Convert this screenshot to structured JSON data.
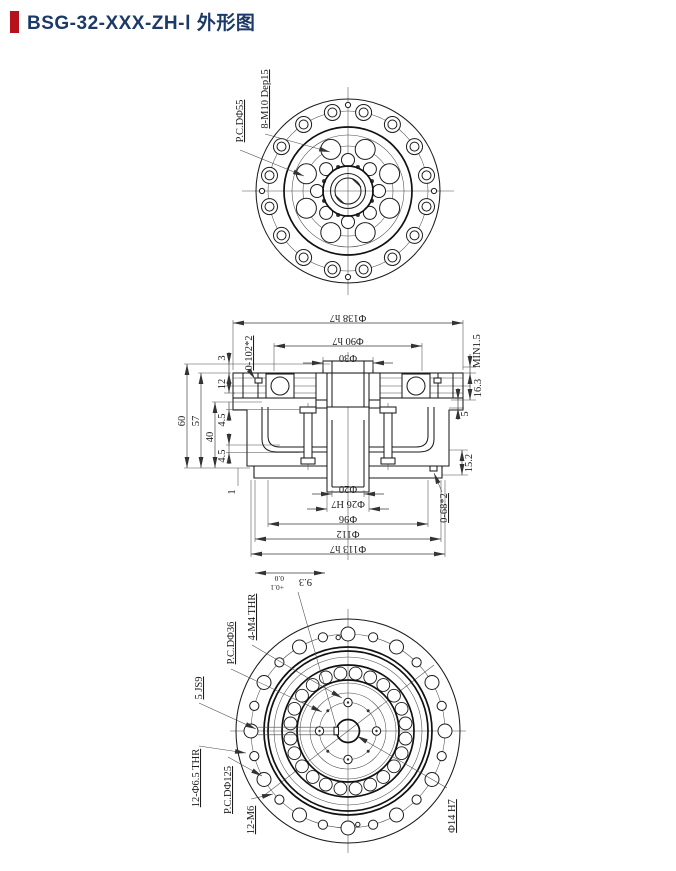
{
  "header": {
    "title": "BSG-32-XXX-ZH-Ⅰ 外形图",
    "accent_color": "#b5121b",
    "title_color": "#1c3a68"
  },
  "views": {
    "top": {
      "pcd_label": "P.C.DΦ55",
      "bolt_label": "8-M10 Dep15"
    },
    "section": {
      "dia_138": "Φ138 h7",
      "dia_90": "Φ90 h7",
      "dia_30": "Φ30",
      "oring_top": "0-102*2",
      "min_gap": "MIN1.5",
      "h_163": "16.3",
      "h_5": "5",
      "h_152": "15.2",
      "oring_bottom": "0-68*2",
      "h_60": "60",
      "h_57": "57",
      "h_40": "40",
      "h_3": "3",
      "h_12": "12",
      "h_45_upper": "4.5",
      "h_45_lower": "4.5",
      "h_1": "1",
      "dia_20": "Φ20",
      "dia_26": "Φ26 H7",
      "dia_96": "Φ96",
      "dia_112": "Φ112",
      "dia_113": "Φ113 h7"
    },
    "bottom": {
      "keyway_depth_value": "9.3",
      "keyway_tol_upper": "+0.1",
      "keyway_tol_lower": "0.0",
      "m4_label": "4-M4 THR",
      "pcd36_label": "P.C.DΦ36",
      "keyway_width_label": "5 JS9",
      "thru_label": "12-Φ6.5 THR",
      "pcd125_label": "P.C.DΦ125",
      "m6_label": "12-M6",
      "bore_label": "Φ14 H7"
    }
  }
}
